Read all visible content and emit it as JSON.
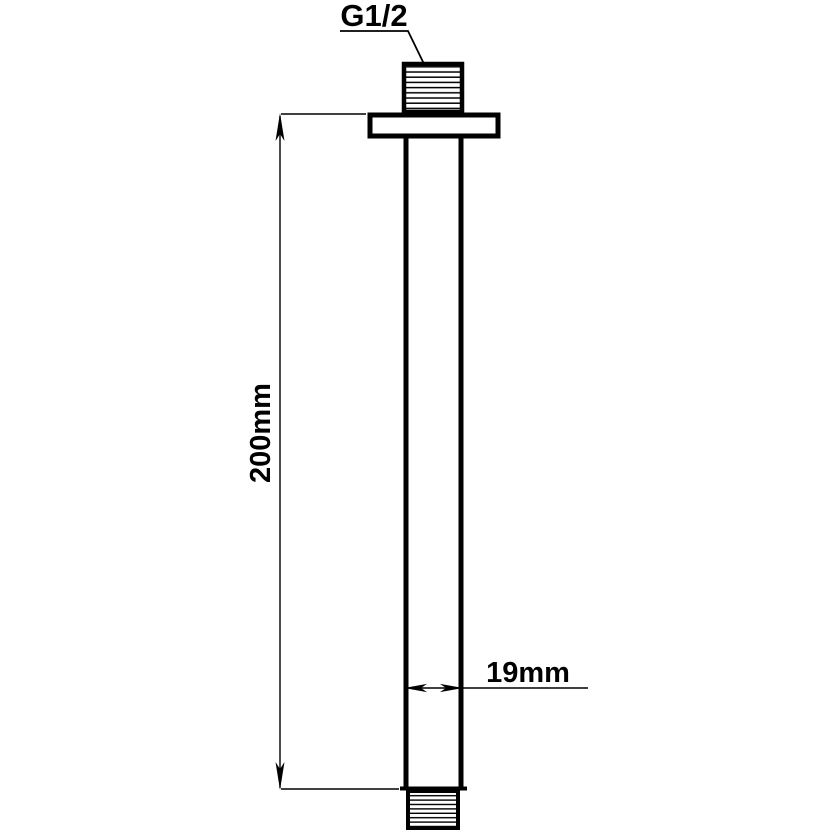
{
  "drawing": {
    "labels": {
      "thread_size": "G1/2",
      "length": "200mm",
      "diameter": "19mm"
    },
    "colors": {
      "line": "#000000",
      "background": "#ffffff"
    }
  }
}
